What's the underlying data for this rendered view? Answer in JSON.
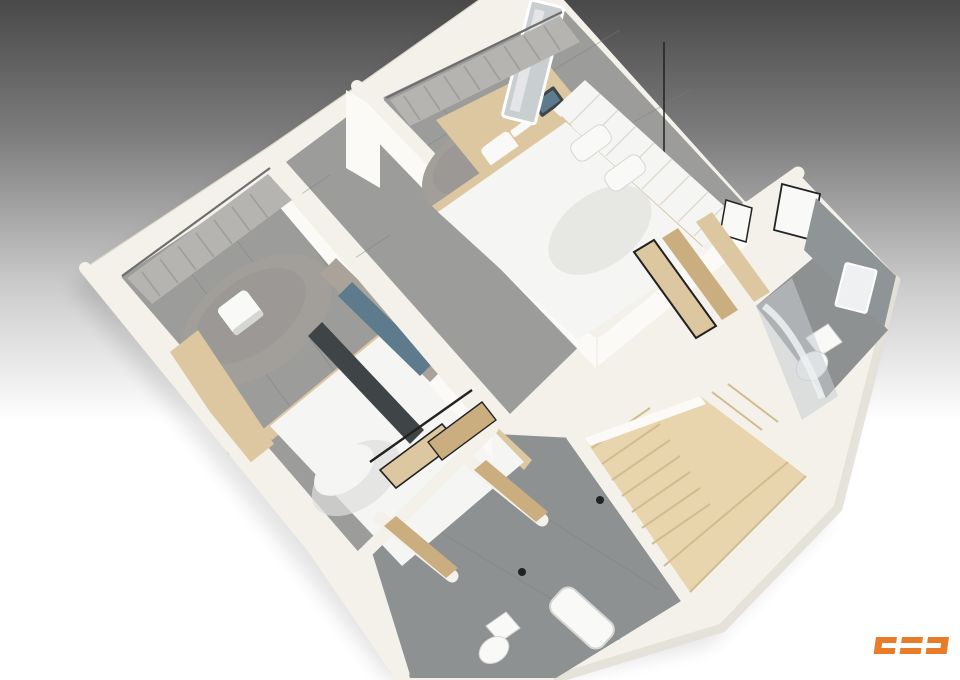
{
  "scene": {
    "type": "isometric-3d-floor-plan-render",
    "description": "Cutaway 3D render of an apartment upper floor viewed from above at an angle"
  },
  "background": {
    "bg_top": "#494949",
    "bg_mid": "#7d7d7d",
    "bg_light": "#cbcbcb",
    "bg_bottom": "#ffffff"
  },
  "colors": {
    "wall": "#f3f1ea",
    "wall_bright": "#fbfaf7",
    "wall_shadow": "#e3e0d8",
    "wall_edge": "#dcd8d0",
    "floor": "#9c9c9a",
    "floor_dark": "#8e9192",
    "tile_line": "#7e7e7c",
    "tile_wall": "#8f9496",
    "curtain": "#b6b4b0",
    "curtain_dark": "#9a9894",
    "rail": "#6f6f6f",
    "wood": "#dcc7a0",
    "wood_mid": "#cbae7f",
    "stair": "#e8d5ae",
    "stair_shade": "#d2bb90",
    "bedding": "#f5f5f3",
    "bedding_shade": "#dededb",
    "rug": "#a29f9b",
    "rug_dark": "#908d89",
    "stone": "#a9a399",
    "tv": "#5d7b8d",
    "console": "#3f4447",
    "fixture": "#f9f9f8",
    "fixture_shade": "#d6d6d4",
    "glass": "#c9ced1",
    "metal": "#eef0f1",
    "black": "#222222"
  },
  "rooms": [
    {
      "id": "bedroom-top",
      "contents": [
        "curtains",
        "led-mirror",
        "desk-with-laptop",
        "chair",
        "round-rug",
        "pendant-lamp",
        "nightstand",
        "double-bed",
        "slatted-headboard"
      ]
    },
    {
      "id": "bedroom-left",
      "contents": [
        "curtains",
        "desk",
        "chair",
        "round-rug",
        "stone-accent-wall",
        "tv-panel",
        "media-console",
        "double-bed"
      ]
    },
    {
      "id": "hallway",
      "contents": [
        "door"
      ]
    },
    {
      "id": "bathroom-right",
      "contents": [
        "tiled-wall",
        "mirror",
        "toilet",
        "glass-shower"
      ]
    },
    {
      "id": "walk-in-closet",
      "contents": [
        "sliding-wood-doors",
        "wood-partitions",
        "picture-frames"
      ]
    },
    {
      "id": "staircase",
      "contents": [
        "winder-stairs",
        "landing"
      ]
    },
    {
      "id": "bathroom-bottom",
      "contents": [
        "sliding-wood-doors",
        "partitions",
        "toilet",
        "bathtub"
      ]
    }
  ],
  "logo": {
    "glyphs": [
      "left-bracket-c",
      "equals-bars",
      "right-bracket-c"
    ],
    "color": "#e87c28"
  }
}
